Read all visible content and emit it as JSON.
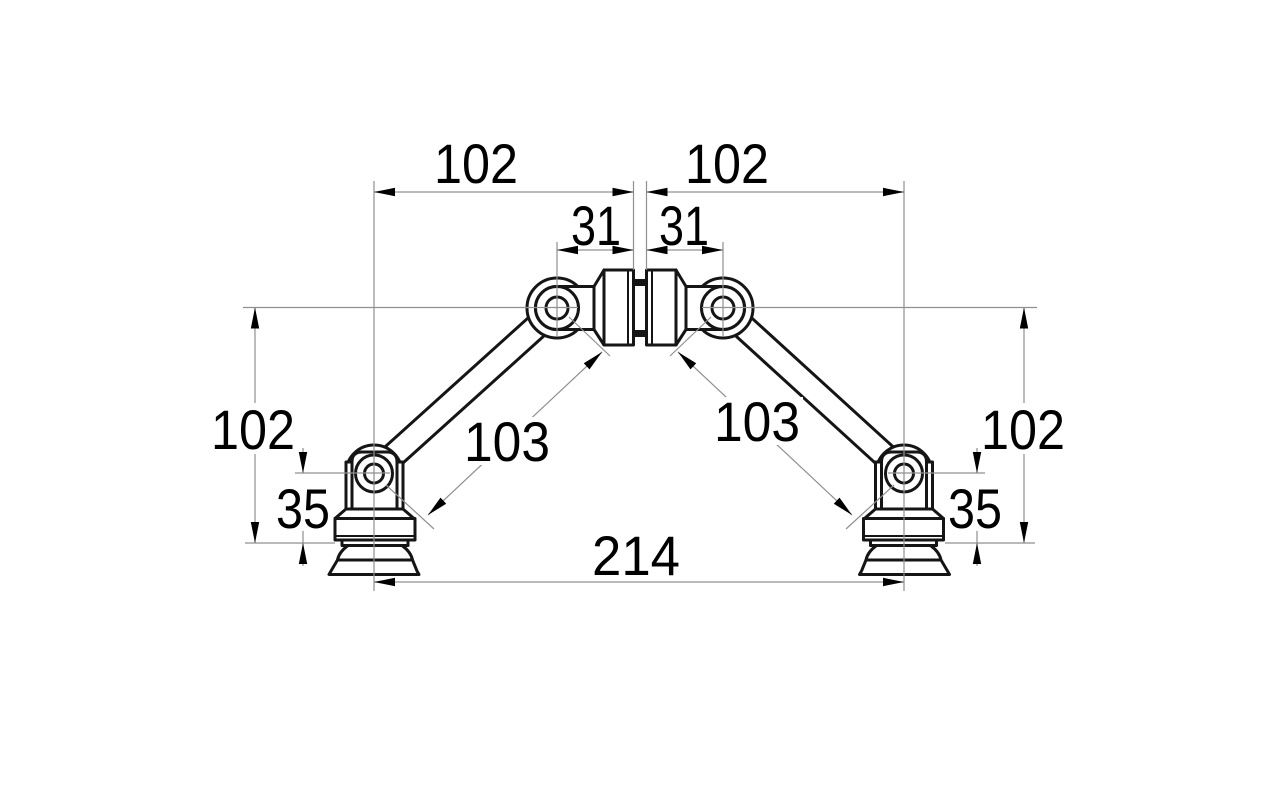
{
  "drawing": {
    "title": "Articulated suction-cup arm dimension drawing",
    "colors": {
      "background": "#ffffff",
      "part_outline": "#151515",
      "dimension_line": "#909090",
      "text": "#000000"
    },
    "dimensions": {
      "top_left_span": "102",
      "top_right_span": "102",
      "hub_left_span": "31",
      "hub_right_span": "31",
      "left_height": "102",
      "right_height": "102",
      "left_foot_height": "35",
      "right_foot_height": "35",
      "left_arm_length": "103",
      "right_arm_length": "103",
      "overall_width": "214"
    }
  }
}
